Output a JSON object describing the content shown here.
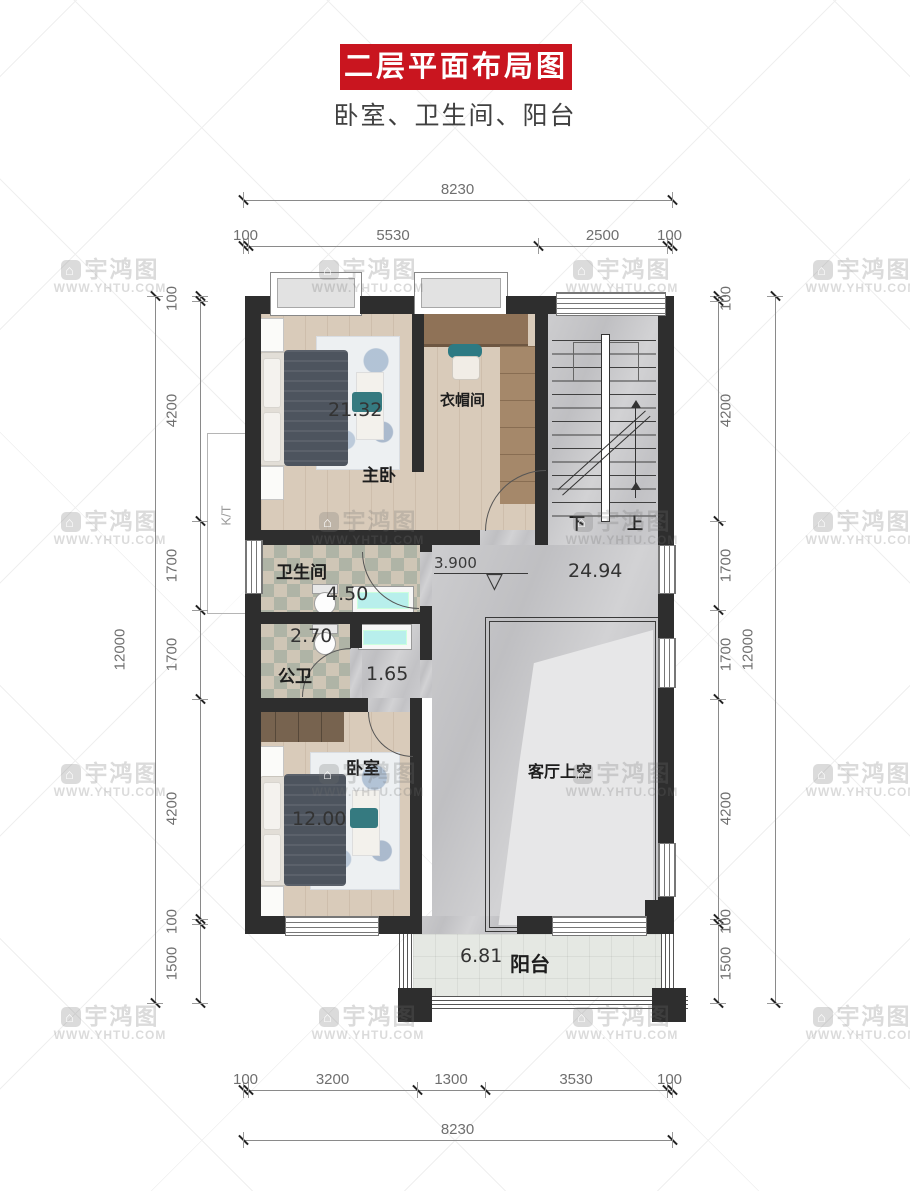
{
  "header": {
    "title": "二层平面布局图",
    "subtitle": "卧室、卫生间、阳台"
  },
  "watermark": {
    "brand": "宇鸿图",
    "url": "WWW.YHTU.COM"
  },
  "rooms": {
    "master_bedroom": {
      "name": "主卧",
      "area": "21.32"
    },
    "cloakroom": {
      "name": "衣帽间"
    },
    "bathroom": {
      "name": "卫生间",
      "area": "4.50"
    },
    "public_bathroom": {
      "name": "公卫",
      "area": "2.70"
    },
    "wash_area": {
      "area": "1.65"
    },
    "bedroom": {
      "name": "卧室",
      "area": "12.00"
    },
    "living_void": {
      "name": "客厅上空"
    },
    "hall": {
      "area": "24.94",
      "elevation": "3.900"
    },
    "balcony": {
      "name": "阳台",
      "area": "6.81"
    },
    "stairs": {
      "down_label": "下",
      "up_label": "上"
    },
    "ac_platform_label": "K/T"
  },
  "dimensions": {
    "top": {
      "overall": "8230",
      "segments": [
        "100",
        "5530",
        "2500",
        "100"
      ]
    },
    "bottom": {
      "overall": "8230",
      "segments": [
        "100",
        "3200",
        "1300",
        "3530",
        "100"
      ]
    },
    "left": {
      "overall": "12000",
      "segments": [
        "100",
        "4200",
        "1700",
        "1700",
        "4200",
        "100",
        "1500"
      ]
    },
    "right": {
      "overall": "12000",
      "segments": [
        "100",
        "4200",
        "1700",
        "1700",
        "4200",
        "100",
        "1500"
      ]
    }
  },
  "colors": {
    "banner_red": "#c9151f",
    "wall": "#2e2e2e",
    "sink_cyan": "#b8efec",
    "teal_accent": "#2d7a83"
  }
}
